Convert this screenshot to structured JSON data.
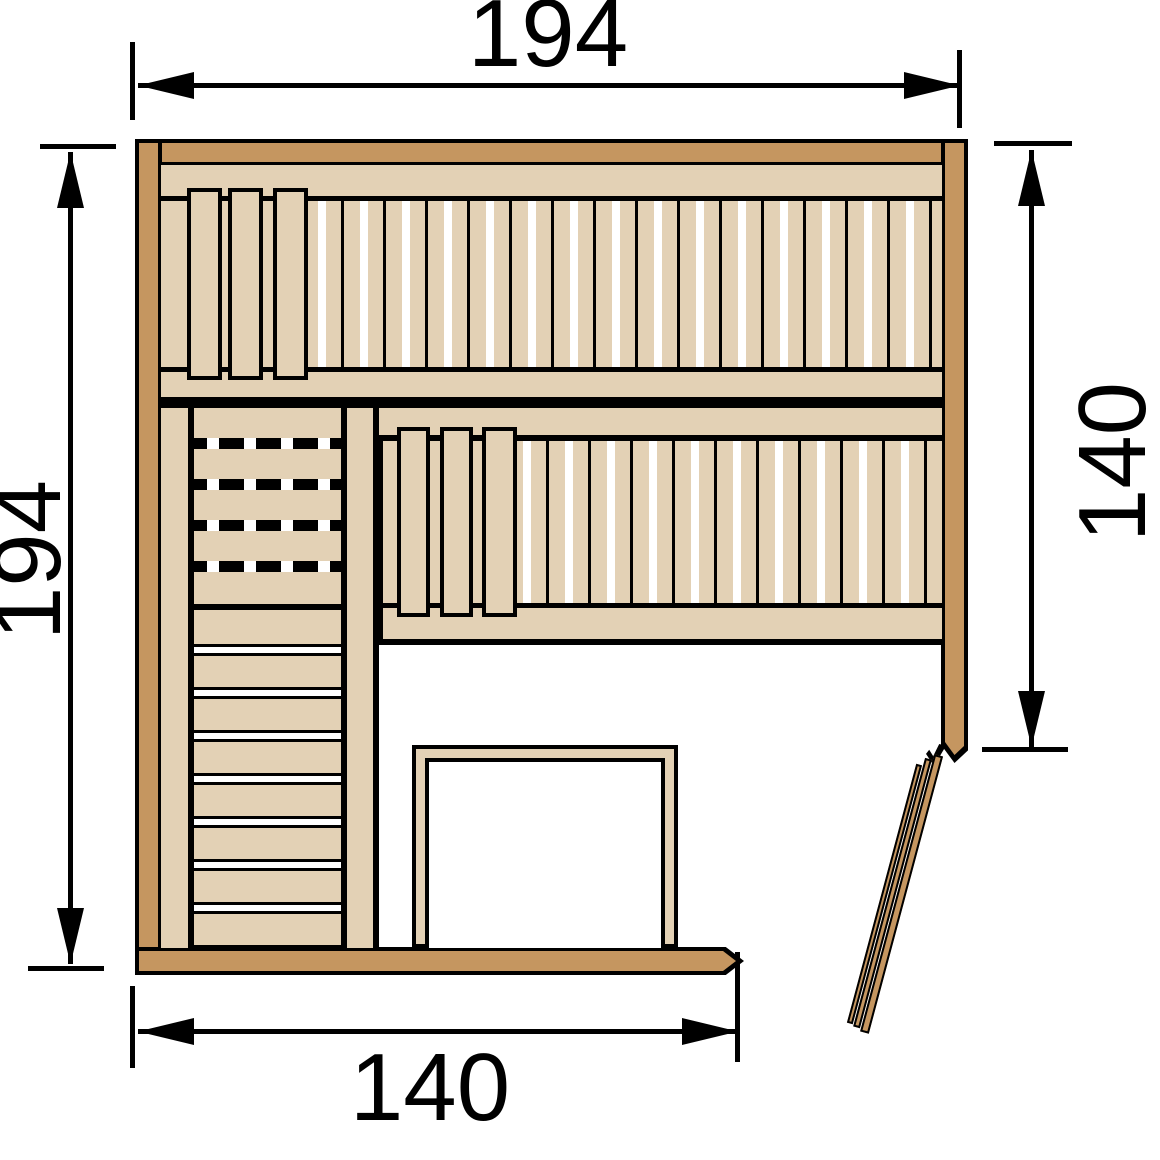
{
  "diagram": {
    "dimensions": {
      "top": "194",
      "left": "194",
      "right": "140",
      "bottom": "140"
    },
    "colors": {
      "wall_wood": "#C59660",
      "bench_wood": "#E3D1B5",
      "outline": "#000000",
      "floor": "#FFFFFF"
    }
  }
}
